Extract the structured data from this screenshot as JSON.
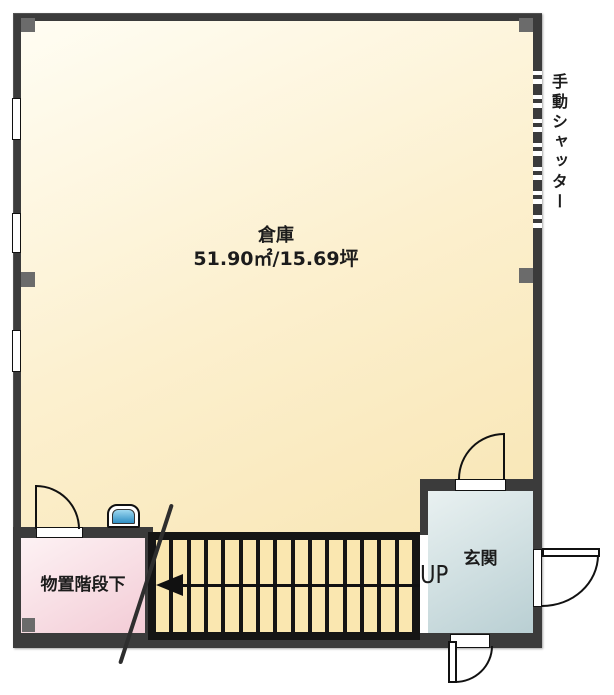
{
  "plan": {
    "warehouse": {
      "name": "倉庫",
      "area": "51.90㎡/15.69坪"
    },
    "storage": {
      "name": "物置階段下"
    },
    "entrance": {
      "name": "玄関",
      "direction_label": "UP"
    },
    "shutter_label": "手動シャッター",
    "stairs": {
      "tread_count": 15,
      "direction": "up-to-left"
    }
  },
  "colors": {
    "wall": "#3b3b3b",
    "warehouse_fill": "#f9e9bc",
    "storage_fill": "#f3ccd6",
    "entrance_fill": "#c3d5d8",
    "tread": "#fae7b0",
    "pillar": "#6b6b6b",
    "fixture_blue": "#2f8fc4",
    "text": "#1c1c1c"
  }
}
